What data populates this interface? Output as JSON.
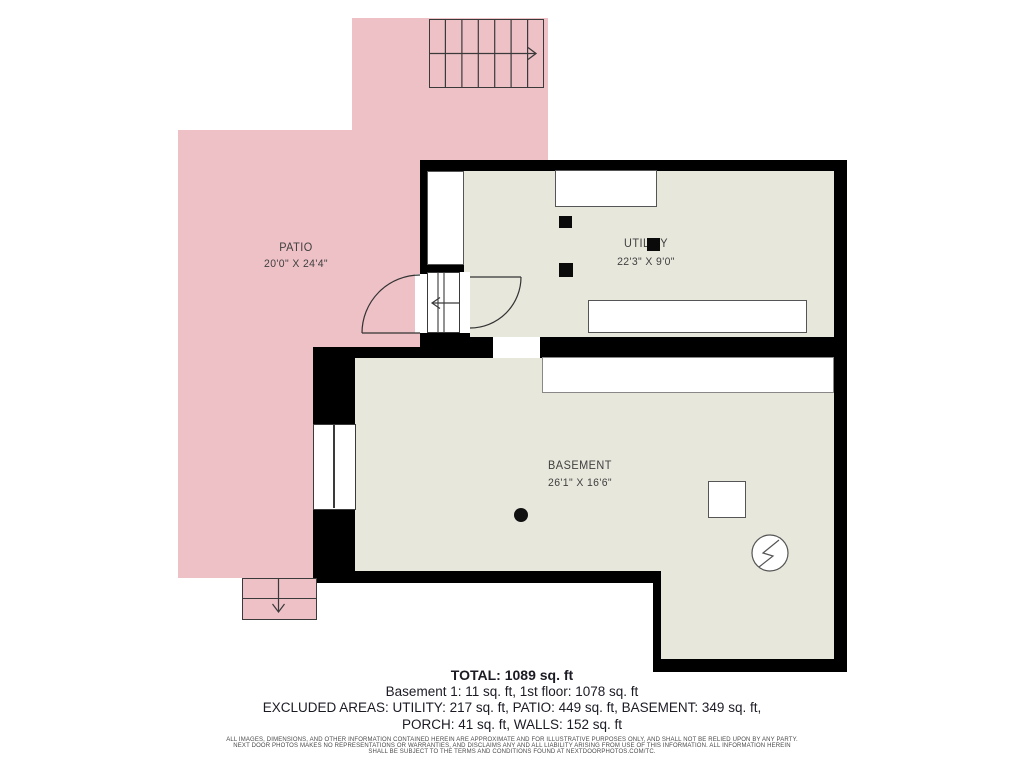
{
  "rooms": {
    "patio": {
      "name": "PATIO",
      "dims": "20'0\" X 24'4\""
    },
    "utility": {
      "name": "UTILITY",
      "dims": "22'3\" X 9'0\""
    },
    "basement": {
      "name": "BASEMENT",
      "dims": "26'1\" X 16'6\""
    }
  },
  "summary": {
    "total": "TOTAL: 1089 sq. ft",
    "floors": "Basement 1: 11 sq. ft, 1st floor: 1078 sq. ft",
    "excluded1": "EXCLUDED AREAS: UTILITY: 217 sq. ft, PATIO: 449 sq. ft, BASEMENT: 349 sq. ft,",
    "excluded2": "PORCH: 41 sq. ft, WALLS: 152 sq. ft"
  },
  "disclaimer": {
    "line1": "ALL IMAGES, DIMENSIONS, AND OTHER INFORMATION CONTAINED HEREIN ARE APPROXIMATE AND FOR ILLUSTRATIVE PURPOSES ONLY, AND SHALL NOT BE RELIED UPON BY ANY PARTY.",
    "line2": "NEXT DOOR PHOTOS MAKES NO REPRESENTATIONS OR WARRANTIES, AND DISCLAIMS ANY AND ALL LIABILITY ARISING FROM USE OF THIS INFORMATION. ALL INFORMATION HEREIN",
    "line3": "SHALL BE SUBJECT TO THE TERMS AND CONDITIONS FOUND AT NEXTDOORPHOTOS.COM/TC."
  },
  "colors": {
    "patio": "#edc1c6",
    "room": "#e8e7dc",
    "wall": "#000000",
    "outline": "#3a3a3a",
    "background": "#ffffff"
  },
  "icons": {
    "electrical_panel": "circle-lightning-icon",
    "stairs_up_arrow": "arrow-right",
    "stairs_down_arrow": "arrow-left",
    "porch_arrow": "arrow-down"
  }
}
